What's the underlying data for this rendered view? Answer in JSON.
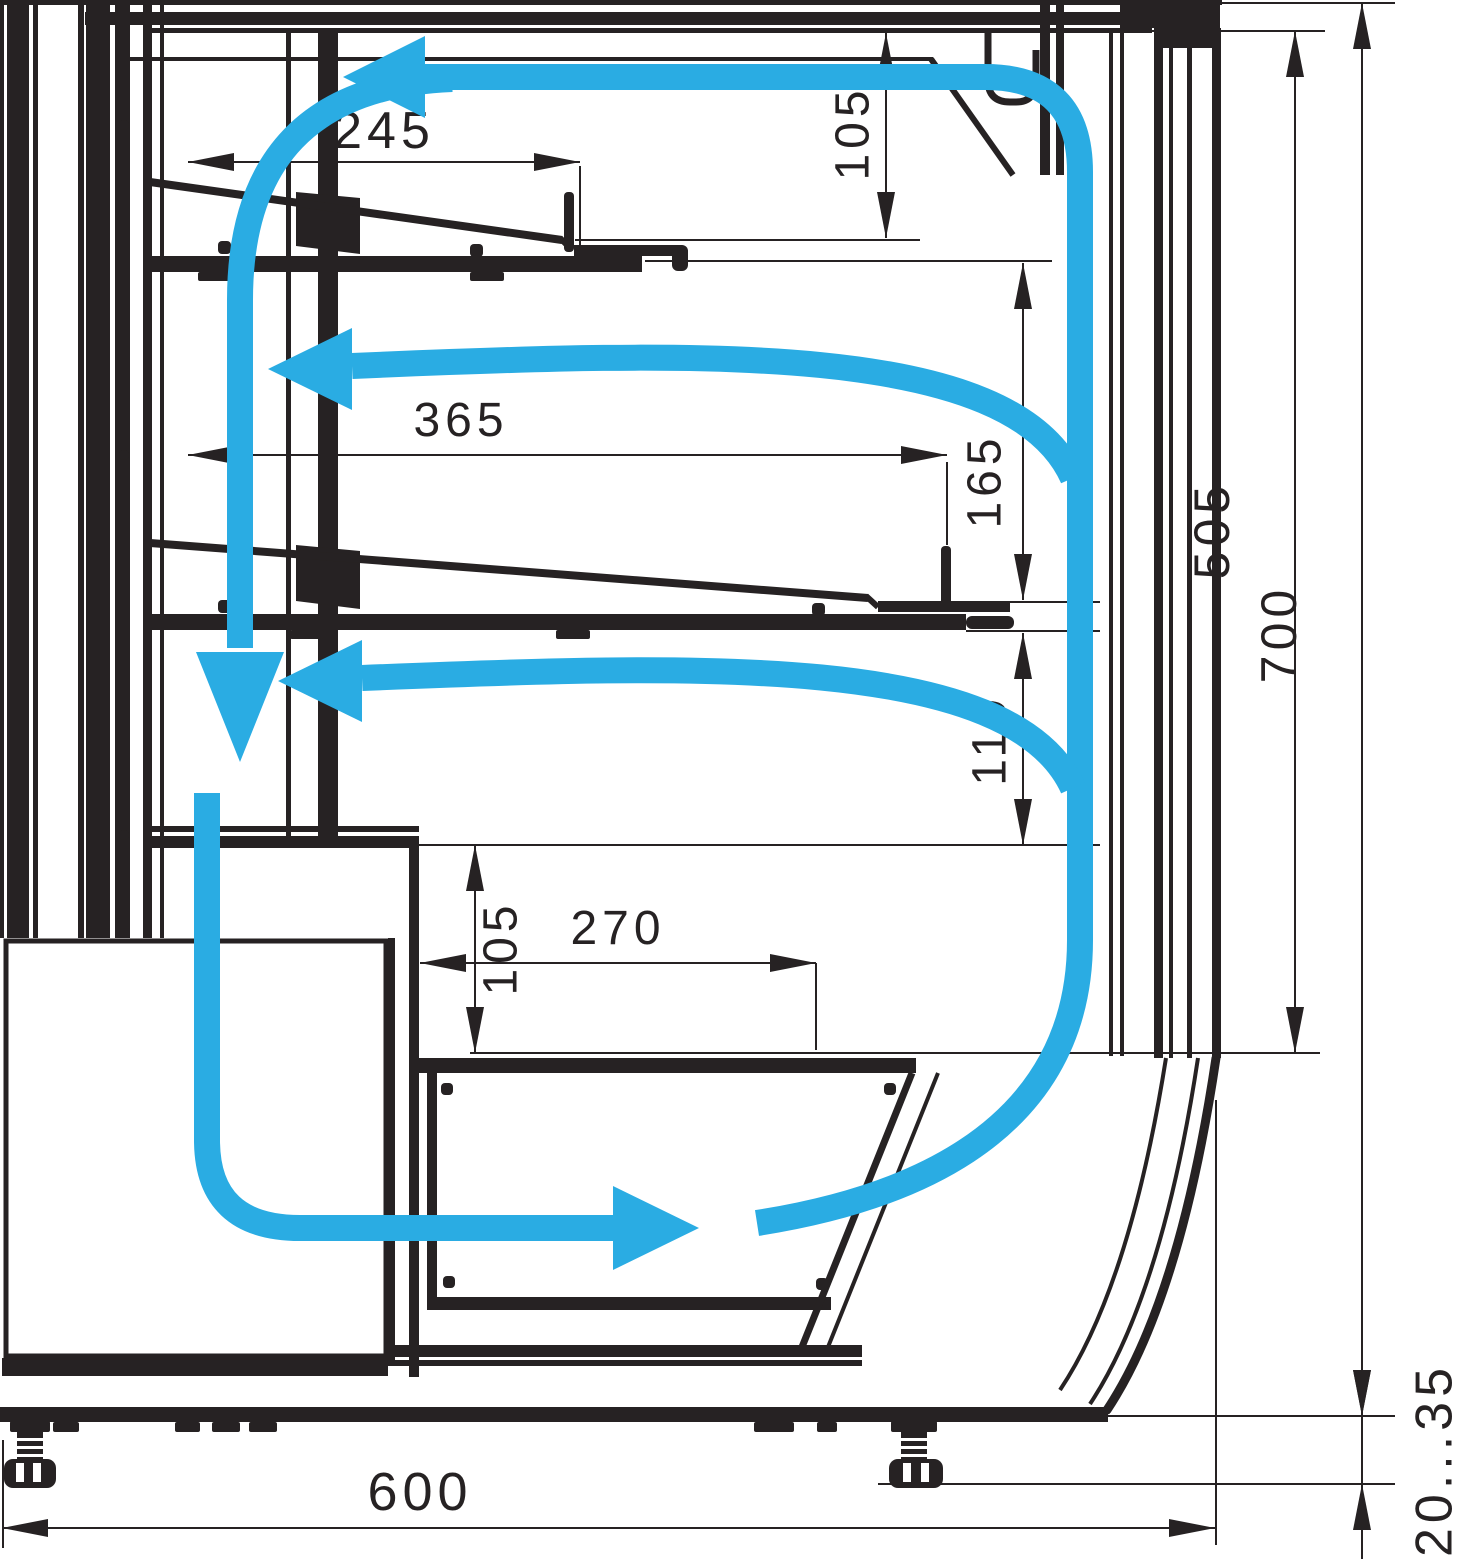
{
  "diagram": {
    "accent_color": "#2AACE3",
    "line_color": "#262223",
    "dimensions": {
      "top_shelf_depth": "245",
      "canopy_clearance": "105",
      "middle_shelf_depth": "365",
      "middle_clearance": "165",
      "inner_height": "505",
      "overall_height": "700",
      "lower_clearance": "110",
      "well_height": "105",
      "well_width": "270",
      "overall_depth": "600",
      "foot_adjust_range": "20...35"
    }
  }
}
